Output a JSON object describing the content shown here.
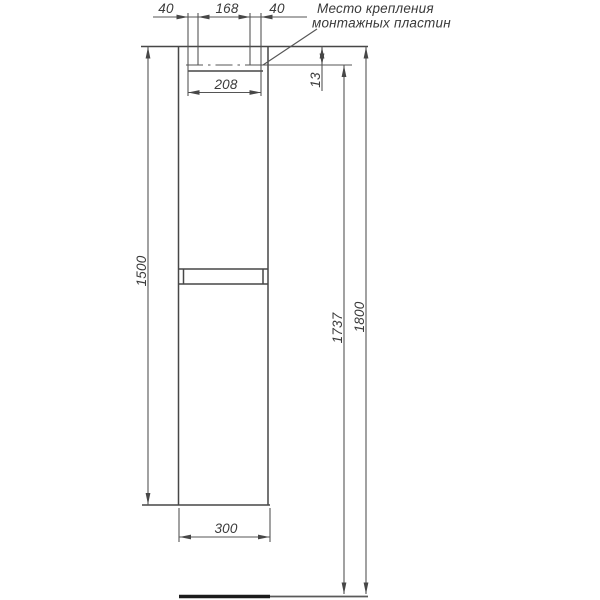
{
  "drawing": {
    "callout": {
      "line1": "Место крепления",
      "line2": "монтажных пластин"
    },
    "dims": {
      "plate_offset_left": "40",
      "plate_spacing": "168",
      "plate_offset_right": "40",
      "plate_span": "208",
      "plate_inset_top": "13",
      "cabinet_height": "1500",
      "cabinet_width": "300",
      "mount_line_height": "1737",
      "overall_height": "1800"
    },
    "colors": {
      "line": "#4d4d4d",
      "text": "#3a3a3a",
      "floor": "#1c1c1c",
      "background": "#ffffff"
    }
  }
}
